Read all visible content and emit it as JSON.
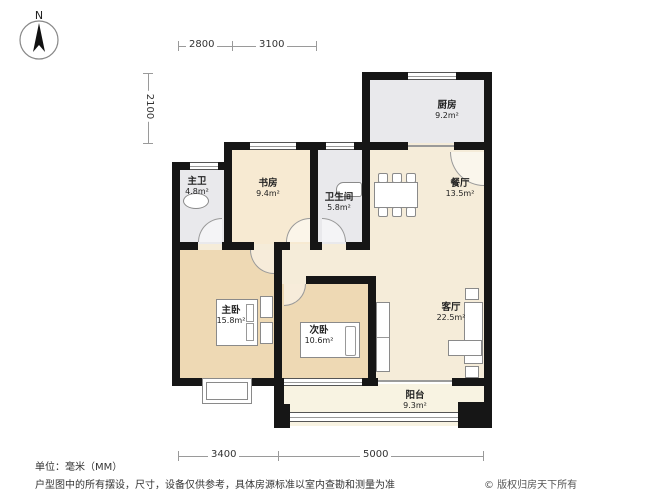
{
  "compass": {
    "label": "N"
  },
  "dimensions": {
    "top": [
      "2800",
      "3100"
    ],
    "left": [
      "2100"
    ],
    "bottom": [
      "3400",
      "5000"
    ]
  },
  "rooms": [
    {
      "id": "kitchen",
      "name": "厨房",
      "area": "9.2m²"
    },
    {
      "id": "master-bath",
      "name": "主卫",
      "area": "4.8m²"
    },
    {
      "id": "study",
      "name": "书房",
      "area": "9.4m²"
    },
    {
      "id": "bathroom",
      "name": "卫生间",
      "area": "5.8m²"
    },
    {
      "id": "dining",
      "name": "餐厅",
      "area": "13.5m²"
    },
    {
      "id": "master-bedroom",
      "name": "主卧",
      "area": "15.8m²"
    },
    {
      "id": "second-bedroom",
      "name": "次卧",
      "area": "10.6m²"
    },
    {
      "id": "living",
      "name": "客厅",
      "area": "22.5m²"
    },
    {
      "id": "balcony",
      "name": "阳台",
      "area": "9.3m²"
    }
  ],
  "footer": {
    "unit_note": "单位：毫米（MM）",
    "disclaimer": "户型图中的所有摆设，尺寸，设备仅供参考，具体房源标准以室内查勘和测量为准",
    "copyright": "© 版权归房天下所有"
  },
  "colors": {
    "wall": "#161616",
    "room_cream": "#f5ecd9",
    "room_study": "#f7ead2",
    "room_gray": "#e9e9ec",
    "room_tan": "#eed9b4",
    "balcony": "#f8f3e2",
    "dimension_line": "#9a9a9a"
  }
}
